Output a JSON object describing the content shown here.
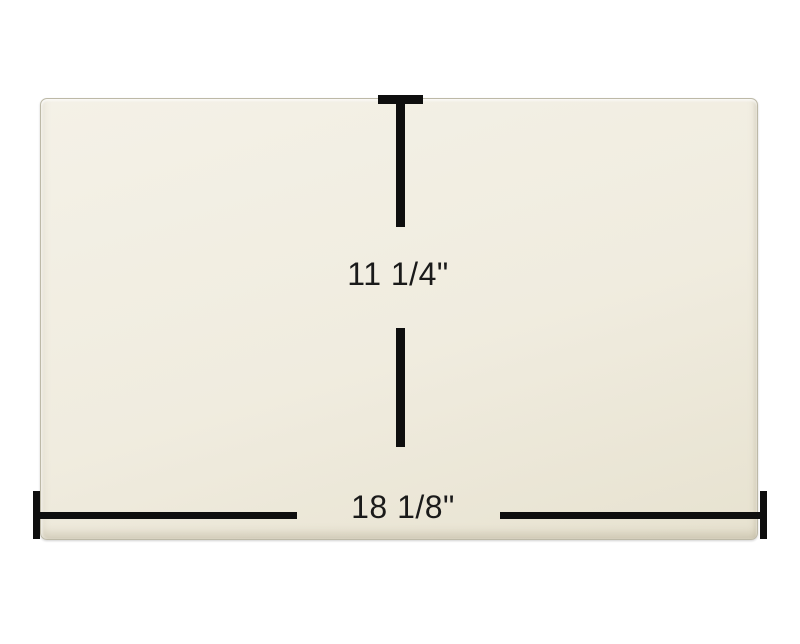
{
  "scene": {
    "description": "Product dimension diagram of a rectangular cream glass panel",
    "background_color": "#ffffff"
  },
  "panel": {
    "name": "glass panel",
    "fill_top": "#f4f1e7",
    "fill_mid": "#f0ecdf",
    "fill_bottom": "#e7e2d0",
    "edge_color": "#bdb9a7"
  },
  "dimensions": {
    "line_color": "#0e0e0e",
    "text_color": "#1a1a1a",
    "height": {
      "label": "11 1/4\""
    },
    "width": {
      "label": "18 1/8\""
    }
  }
}
